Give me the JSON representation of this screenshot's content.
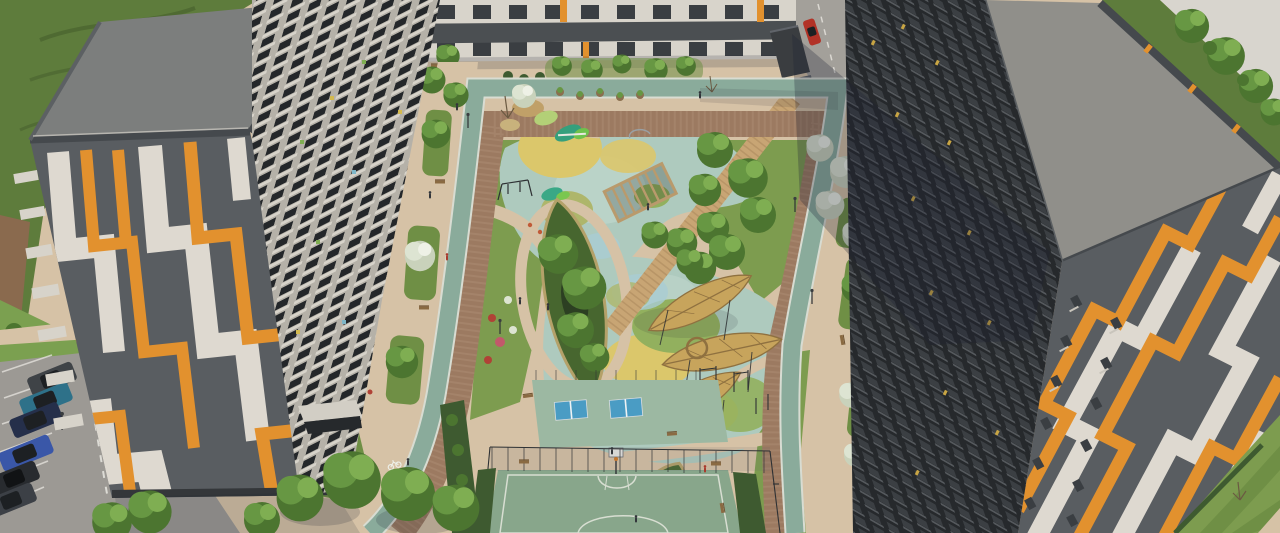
{
  "image": {
    "kind": "3d-architectural-aerial-render",
    "subject": "residential-complex-courtyard",
    "description": "Aerial render of two orange/white/gray striped apartment buildings framing a landscaped courtyard with playgrounds, leaf-shaped canopies, sports courts, bike lane loop and street parking"
  },
  "scene": {
    "left_building": {
      "facade_pattern": "vertical orange-white zigzag on gray",
      "roof": "flat gray",
      "courtyard_side": "white balconies grid",
      "entrance_canopy": true
    },
    "right_building": {
      "facade_pattern": "diagonal orange-white zigzag on gray",
      "roof": "flat gray",
      "courtyard_side": "dark shaded balconies grid with lit windows"
    },
    "background_building": {
      "type": "low street-front block",
      "facade": "white with window rows and orange piers"
    },
    "courtyard": {
      "features": [
        "bike-lane-loop",
        "cobble-ring-path",
        "upper-playground",
        "green-slides",
        "swing-frame",
        "pergola",
        "boardwalk",
        "leaf-shaped-planter",
        "small-leaf-planter",
        "leaf-shaped-canopies",
        "fitness-area",
        "table-tennis-tables",
        "basketball-court",
        "court-fence",
        "benches",
        "flower-beds",
        "white-flowering-shrubs",
        "planter-pots",
        "lamp-posts",
        "pedestrians"
      ],
      "table_tennis_count": 2,
      "leaf_canopy_count": 3
    },
    "parking": {
      "car_count": 6,
      "car_colors": [
        "car_gray",
        "car_teal",
        "car_navy",
        "car_blue",
        "car_dark",
        "car_gray2"
      ],
      "markings": [
        "stall-lines",
        "dashed-aisle-line"
      ]
    },
    "street": {
      "red_car": true,
      "pavilions": 2,
      "crosswalk_dashes": true
    },
    "surroundings": [
      "rough-green-field-top-left",
      "dirt-strip",
      "white-building-top-right",
      "tree-cluster-top-right",
      "striped-mown-lawn-bottom-right",
      "tree-row-bottom"
    ]
  },
  "palette": {
    "ground_beige": "#d6c2a6",
    "paving_brown": "#9c7a61",
    "paving_brown_light": "#b5947a",
    "bike_path": "#8aab9b",
    "bike_edge": "#d8dcd2",
    "line_white": "#e8e6e0",
    "lawn": "#7d9c4f",
    "lawn_dark": "#6f8f45",
    "field_green": "#5e7c3c",
    "field_track": "#49632e",
    "dirt": "#8a6a4e",
    "grass_bright": "#7ba050",
    "hedge": "#3e5a30",
    "foliage_dark": "#4c7530",
    "foliage_mid": "#679743",
    "foliage_light": "#7fae52",
    "flower_white": "#c9d2bb",
    "flower_red": "#b04236",
    "playground_base": "#aecabe",
    "playground_light": "#c2d8ce",
    "circle_yellow": "#dbc76b",
    "circle_olive": "#aeb66b",
    "circle_green": "#92b05e",
    "circle_blue": "#a9ccd3",
    "court_green": "#88a68b",
    "court_line": "#d8ded2",
    "tt_pad": "#9cb8a2",
    "tt_table": "#4a9cc4",
    "leaf_canopy": "#c7a45c",
    "leaf_canopy_rib": "#8f7140",
    "planter_green": "#47662f",
    "planter_rim": "#b4a169",
    "boardwalk": "#c8a574",
    "pergola_wood": "#b99a6c",
    "facade_gray": "#595d61",
    "stripe_orange": "#e2912e",
    "stripe_white": "#ded9d0",
    "roof_gray": "#7c7e7d",
    "roof_gray_right": "#908f8a",
    "roof_edge": "#45494d",
    "balcony_base": "#b5b1a8",
    "balcony_open": "#24272a",
    "balcony_slab": "#d7d3ca",
    "balcony_dark_base": "#26292c",
    "balcony_dark_front": "#3b3f43",
    "balcony_dark_slab": "#55595d",
    "window_lit": "#c8a544",
    "bg_building": "#d8d4cb",
    "bg_window": "#3a3e42",
    "bg_roofband": "#4b4f52",
    "white_bldg": "#d8d5ce",
    "road_gray": "#a3a09a",
    "asphalt": "#9c9994",
    "bench_wood": "#8a6a42",
    "metal_dark": "#2e3134",
    "shadow": "#1d2133",
    "car_gray": "#3f4347",
    "car_teal": "#2e7189",
    "car_navy": "#252f4a",
    "car_blue": "#3a57a8",
    "car_dark": "#282b2f",
    "car_gray2": "#3c4046",
    "car_red": "#b23227",
    "car_glass": "#1d2023"
  }
}
